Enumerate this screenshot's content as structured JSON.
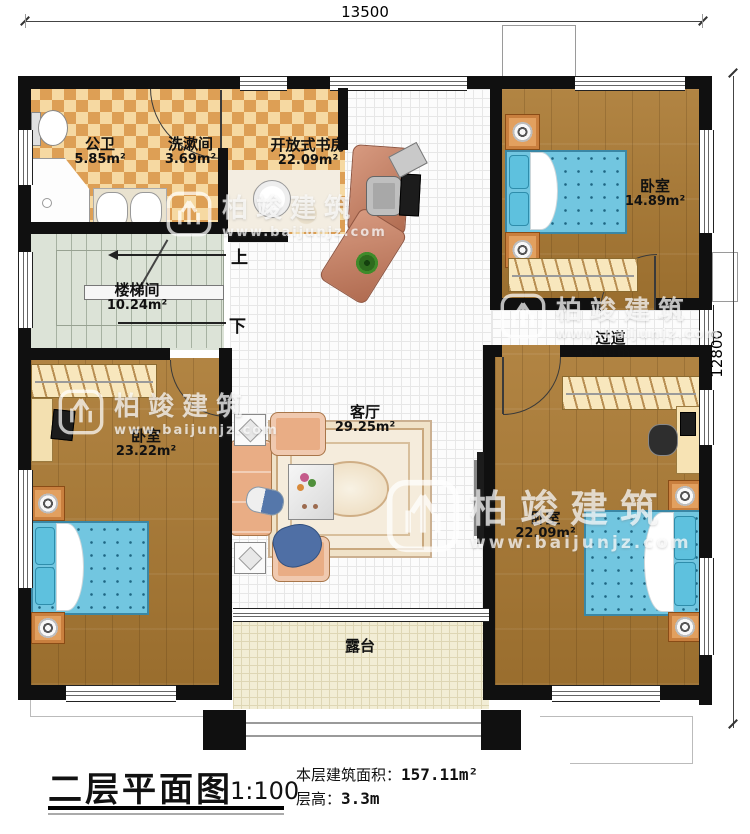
{
  "dimensions": {
    "top": "13500",
    "right": "12800"
  },
  "rooms": {
    "bathroom": {
      "name": "公卫",
      "area": "5.85m²"
    },
    "washroom": {
      "name": "洗漱间",
      "area": "3.69m²"
    },
    "study": {
      "name": "开放式书房",
      "area": "22.09m²"
    },
    "bedroom_top_right": {
      "name": "卧室",
      "area": "14.89m²"
    },
    "stairwell": {
      "name": "楼梯间",
      "area": "10.24m²"
    },
    "corridor": {
      "name": "过道",
      "area": "5.44m²"
    },
    "bedroom_left": {
      "name": "卧室",
      "area": "23.22m²"
    },
    "living_room": {
      "name": "客厅",
      "area": "29.25m²"
    },
    "bedroom_bottom_right": {
      "name": "卧室",
      "area": "22.09m²"
    },
    "terrace": {
      "name": "露台"
    }
  },
  "stairs": {
    "up_label": "上",
    "down_label": "下"
  },
  "watermark": {
    "brand": "柏竣建筑",
    "url": "www.baijunjz.com"
  },
  "title_block": {
    "title": "二层平面图",
    "scale": "1:100",
    "area_label": "本层建筑面积：",
    "area_value": "157.11m²",
    "floor_height_label": "层高：",
    "floor_height_value": "3.3m"
  },
  "colors": {
    "wall": "#101010",
    "wood_floor": "#ab7a33",
    "tile_light": "#f6d9a2",
    "tile_dark": "#dd9f55",
    "stair_floor": "#dce3d7",
    "terrace_floor": "#f2edd5",
    "bed": "#72c6e0",
    "sofa": "#e9ad85",
    "desk": "#c98a70"
  }
}
